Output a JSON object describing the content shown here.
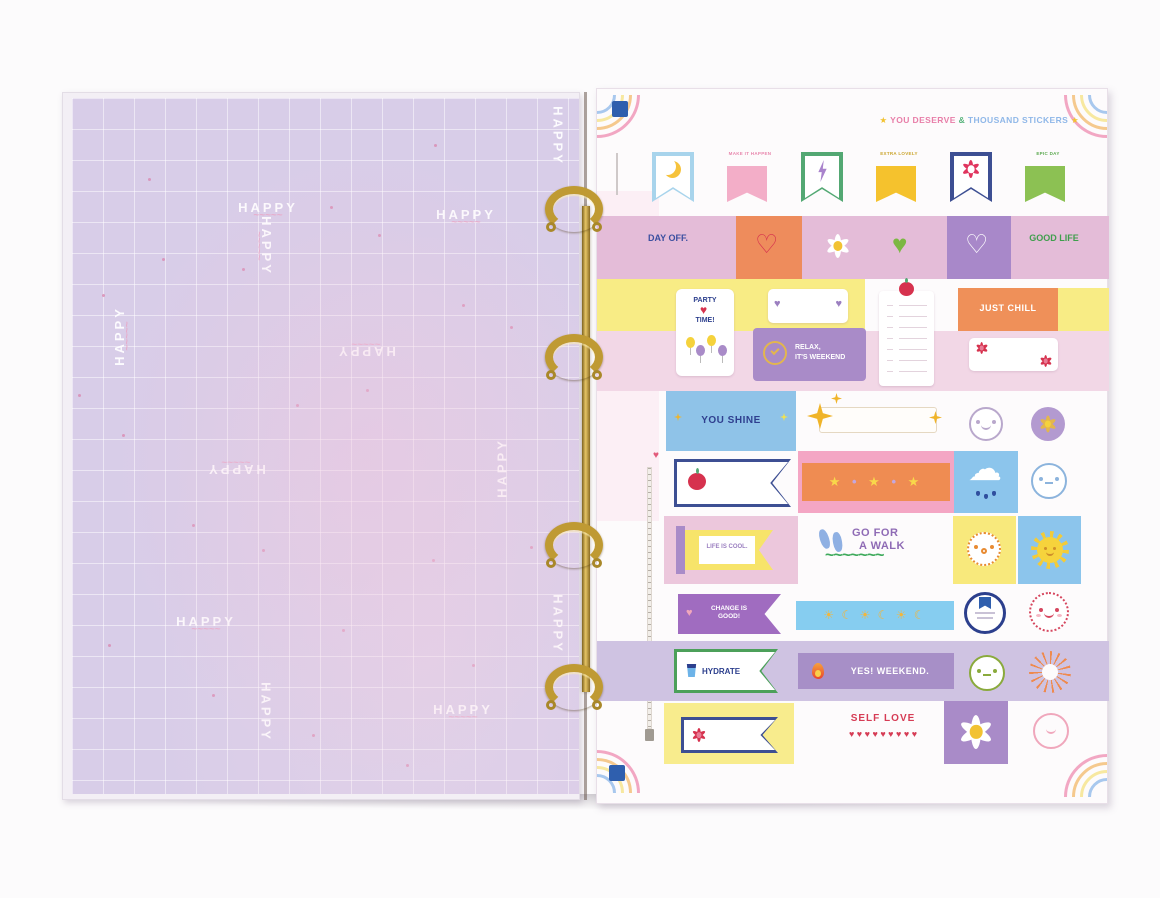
{
  "scene": {
    "description": "Open ring binder: lilac HAPPY grid page on the left, pastel sticker sheet on the right, gold rings"
  },
  "colors": {
    "lilac_page": "#d8cde8",
    "gold": "#bf9a33",
    "pink_band": "#e4bcd8",
    "orange": "#ee8c5c",
    "yellow": "#f8ec85",
    "purple": "#a98bc8",
    "blue": "#8ec7ea",
    "green": "#7cb743",
    "navy": "#2c3f8d",
    "red": "#d6475f",
    "lavender_band": "#cfc3e2",
    "corner_blue": "#2f5fae"
  },
  "icons": {
    "heart": "♥",
    "heart_outline": "♡",
    "star": "★",
    "sun": "☀",
    "moon": "☾",
    "cloud": "☁",
    "wave": "~~~~~~~"
  },
  "left_page": {
    "pattern_word": "HAPPY",
    "wavy_underline": "~~~~~",
    "happy_words": [
      {
        "x": 196,
        "y": 112,
        "rot": 0,
        "wavy": true
      },
      {
        "x": 486,
        "y": 38,
        "rot": 90,
        "wavy": false
      },
      {
        "x": 192,
        "y": 148,
        "rot": 90,
        "wavy": true
      },
      {
        "x": 394,
        "y": 119,
        "rot": 0,
        "wavy": true
      },
      {
        "x": 50,
        "y": 238,
        "rot": 270,
        "wavy": true
      },
      {
        "x": 294,
        "y": 251,
        "rot": 180,
        "wavy": true
      },
      {
        "x": 430,
        "y": 370,
        "rot": 270,
        "wavy": false
      },
      {
        "x": 164,
        "y": 369,
        "rot": 180,
        "wavy": true
      },
      {
        "x": 134,
        "y": 526,
        "rot": 0,
        "wavy": true
      },
      {
        "x": 486,
        "y": 526,
        "rot": 90,
        "wavy": false
      },
      {
        "x": 194,
        "y": 614,
        "rot": 90,
        "wavy": false
      },
      {
        "x": 391,
        "y": 614,
        "rot": 0,
        "wavy": true
      }
    ],
    "dots": [
      [
        76,
        80
      ],
      [
        258,
        108
      ],
      [
        362,
        46
      ],
      [
        390,
        206
      ],
      [
        90,
        160
      ],
      [
        30,
        196
      ],
      [
        170,
        170
      ],
      [
        306,
        136
      ],
      [
        6,
        296
      ],
      [
        224,
        306
      ],
      [
        50,
        336
      ],
      [
        294,
        291
      ],
      [
        120,
        426
      ],
      [
        360,
        461
      ],
      [
        190,
        451
      ],
      [
        270,
        531
      ],
      [
        400,
        566
      ],
      [
        36,
        546
      ],
      [
        140,
        596
      ],
      [
        240,
        636
      ],
      [
        334,
        666
      ],
      [
        438,
        228
      ],
      [
        458,
        448
      ]
    ]
  },
  "right_page": {
    "header": {
      "star_left": "★",
      "text1": "YOU DESERVE",
      "text2": "&",
      "text3": "THOUSAND STICKERS",
      "star_right": "★"
    },
    "flag_row": {
      "labels": [
        "",
        "MAKE IT HAPPEN",
        "",
        "EXTRA LOVELY",
        "",
        "EPIC DAY"
      ]
    },
    "rows": {
      "row2": {
        "day_off": "DAY OFF.",
        "good_life": "GOOD LIFE"
      },
      "row3": {
        "party_top": "PARTY",
        "party_bottom": "TIME!",
        "just_chill": "JUST CHILL",
        "relax_line1": "RELAX,",
        "relax_line2": "IT'S WEEKEND"
      },
      "row4": {
        "you_shine": "YOU SHINE"
      },
      "row5": {
        "star_strip": "★ • ★ • ★"
      },
      "row6": {
        "life_is_cool": "LIFE IS COOL.",
        "walk_line1": "GO FOR",
        "walk_line2": "A WALK"
      },
      "row7": {
        "change": "CHANGE IS GOOD!",
        "sun_moon_strip": "☀ ☾ ☀ ☾ ☀ ☾"
      },
      "row8": {
        "hydrate": "HYDRATE",
        "yes_weekend": "YES! WEEKEND."
      },
      "row9": {
        "self_love": "SELF LOVE",
        "hearts": "♥ ♥ ♥ ♥ ♥ ♥ ♥ ♥ ♥"
      }
    }
  }
}
